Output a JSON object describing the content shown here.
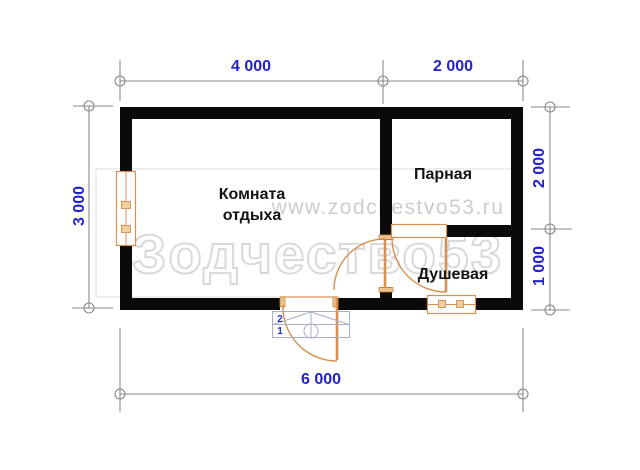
{
  "title": "Floor plan 6x3 bath house",
  "watermarks": {
    "brand": "Зодчество53",
    "url": "www.zodchestvo53.ru"
  },
  "rooms": {
    "rest": "Комната отдыха",
    "steam": "Парная",
    "shower": "Душевая"
  },
  "dims": {
    "top_left": "4 000",
    "top_right": "2 000",
    "left": "3 000",
    "right_top": "2 000",
    "right_bottom": "1 000",
    "bottom": "6 000"
  },
  "porch": {
    "step2": "2",
    "step1": "1"
  },
  "colors": {
    "wall": "#0a0a0a",
    "dim_text": "#2222cc",
    "dim_line": "#8a8a8a",
    "joinery": "#d89050",
    "porch_line": "#a9b0c6",
    "watermark": "#d9d9d9"
  }
}
